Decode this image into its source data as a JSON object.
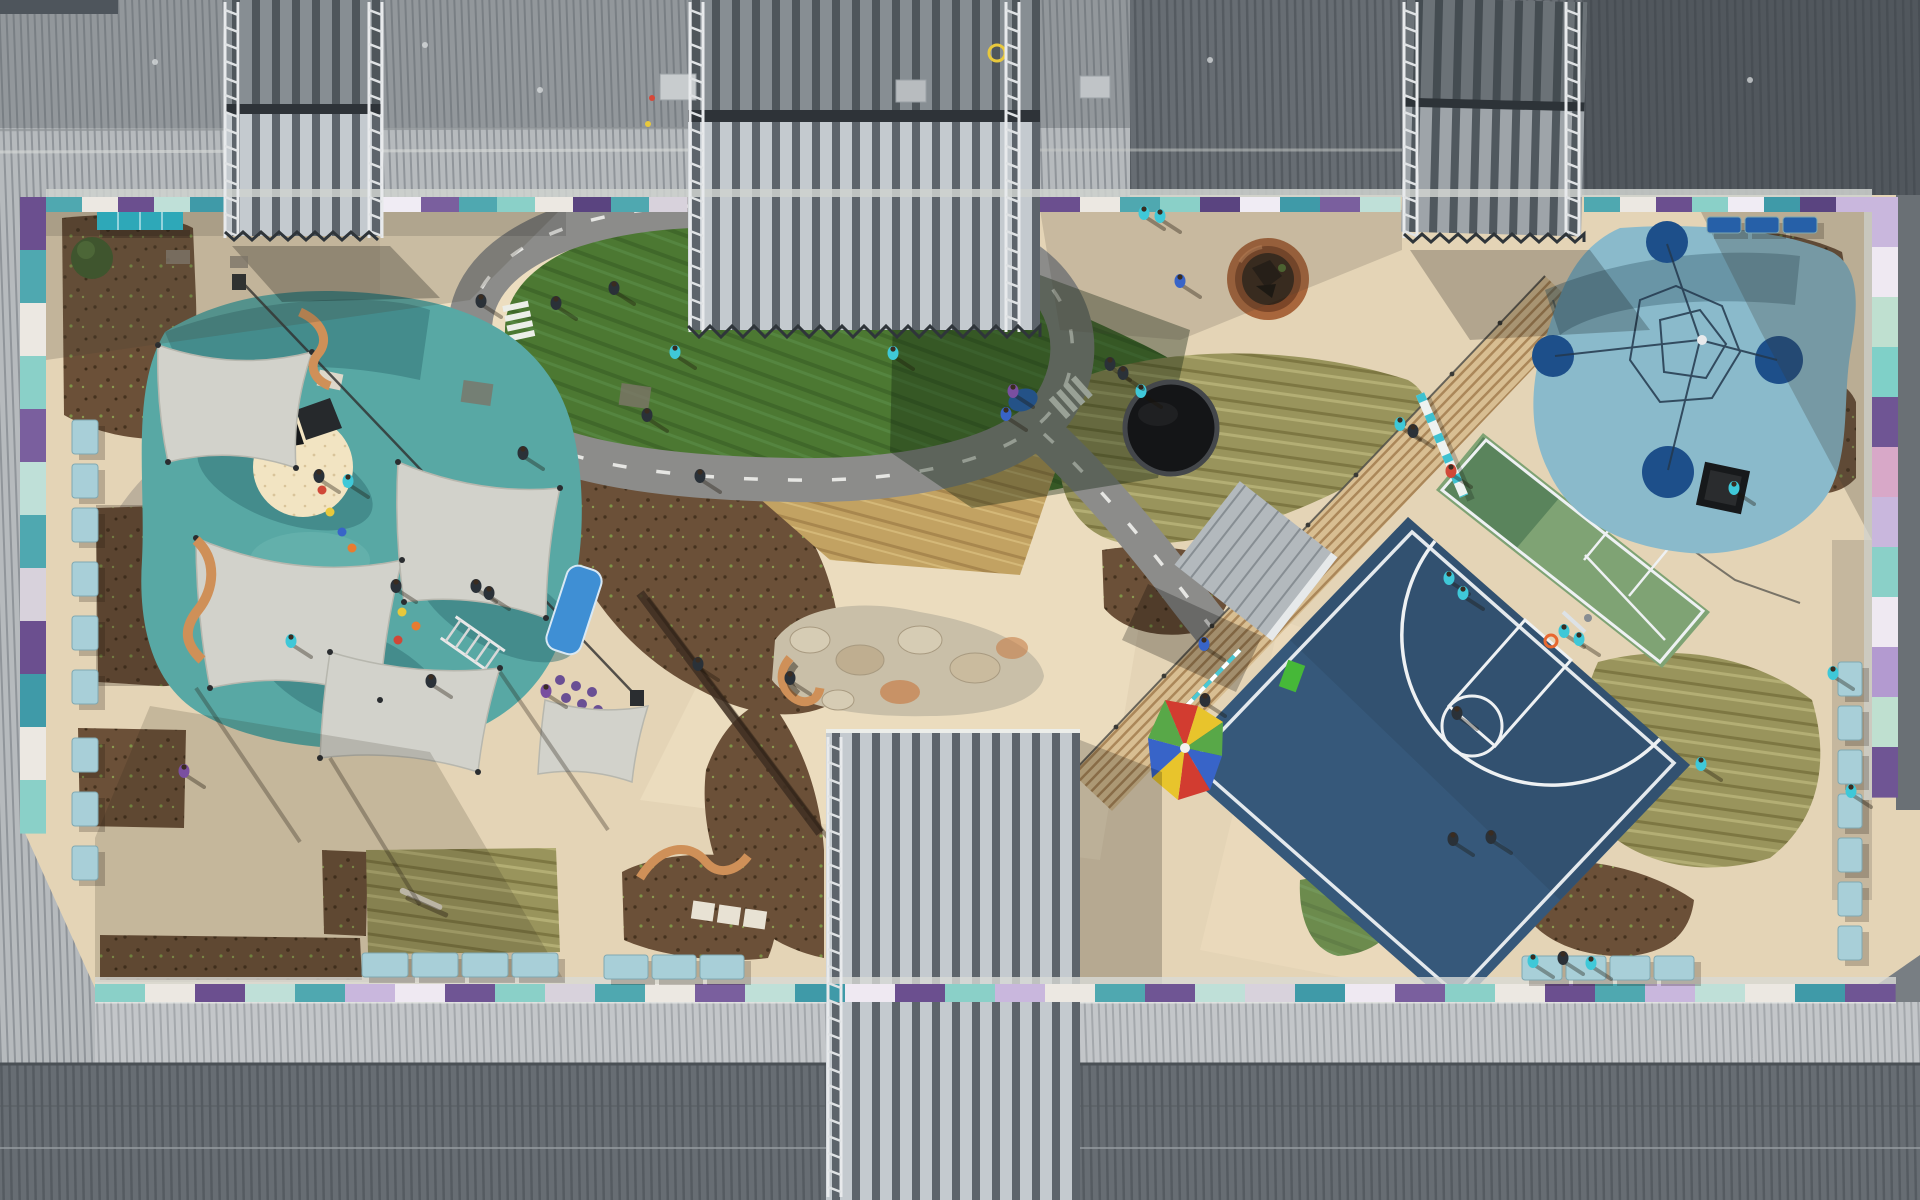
{
  "scene": {
    "type": "aerial-drone-photograph",
    "description": "Top-down aerial view of a school courtyard playground surrounded by gray corrugated metal roofs",
    "areas": [
      "shade-sail playground",
      "bike track with grass oval",
      "trampoline",
      "fire pit",
      "basketball court",
      "green multi-court",
      "climbing-net playground",
      "sand pit",
      "garden beds",
      "bench rows",
      "rainbow parachute",
      "boardwalk"
    ]
  },
  "palette": {
    "tan": "#e4d4b6",
    "tanBright": "#f4e6c8",
    "concreteShade": "#b2a390",
    "teal": "#58a8a4",
    "tealDark": "#2f6f74",
    "blueCourt": "#36587a",
    "greenCourt": "#7fa374",
    "greenCourtDark": "#56815a",
    "grass": "#4c7832",
    "grassDark": "#2f4f1e",
    "grassDry": "#99945c",
    "bluePlay": "#8abacb",
    "navyCircle": "#1d4f8a",
    "sand": "#f2e4c2",
    "mulch": "#6b5038",
    "sail": "#d2d2cb",
    "track": "#8c8c8a",
    "stone": "#c9bfa8",
    "wood": "#d8be92",
    "benchBlue": "#a8cfd8",
    "benchTeal": "#2ea8b8",
    "navyBench": "#2660a8",
    "orangeBench": "#cf9058",
    "trampoline": "#141517",
    "firepitRing": "#a8663c",
    "firepitInner": "#35261a",
    "roofLight": "#b6babd",
    "roofDark": "#62686e",
    "kidCyan": "#3fc8d8",
    "kidDark": "#2a3138",
    "kidPurple": "#7a4fa0",
    "kidRed": "#d04838",
    "kidBlue": "#3864c8",
    "parachute": [
      "#d23c30",
      "#e8c42c",
      "#58a848",
      "#3864c8"
    ]
  },
  "strips": [
    {
      "name": "wall-panels-top-1",
      "dir": "h",
      "x": 46,
      "y": 197,
      "block": 36,
      "h": 15,
      "colors": [
        "#4fa8b0",
        "#ece8e2",
        "#6b4f8f",
        "#bfe0d8",
        "#3f9aa8"
      ]
    },
    {
      "name": "wall-panels-top-2",
      "dir": "h",
      "x": 383,
      "y": 197,
      "block": 38,
      "h": 15,
      "colors": [
        "#f0ecf4",
        "#7a5f9e",
        "#4fa8b0",
        "#8ad0c8",
        "#ece8e2",
        "#5a4480",
        "#4fa8b0",
        "#d8d2dc"
      ]
    },
    {
      "name": "wall-panels-top-3",
      "dir": "h",
      "x": 1040,
      "y": 197,
      "block": 40,
      "h": 15,
      "colors": [
        "#6b4f8f",
        "#ece8e2",
        "#4fa8b0",
        "#8ad0c8",
        "#5a4480",
        "#f0ecf4",
        "#3f9aa8",
        "#7a5f9e",
        "#bfe0d8"
      ]
    },
    {
      "name": "wall-panels-top-4",
      "dir": "h",
      "x": 1584,
      "y": 197,
      "block": 36,
      "h": 15,
      "colors": [
        "#4fa8b0",
        "#ece8e2",
        "#6b4f8f",
        "#8ad0c8",
        "#f0ecf4",
        "#3f9aa8",
        "#5a4480",
        "#c9b7dd"
      ]
    },
    {
      "name": "wall-panels-left",
      "dir": "v",
      "x": 20,
      "y": 197,
      "block": 53,
      "w": 26,
      "colors": [
        "#6b4f8f",
        "#4fa8b0",
        "#ece8e2",
        "#8ad0c8",
        "#7a5f9e",
        "#bfe0d8",
        "#4fa8b0",
        "#d8d2dc",
        "#6b4f8f",
        "#3f9aa8",
        "#ece8e2",
        "#8ad0c8"
      ]
    },
    {
      "name": "wall-panels-right",
      "dir": "v",
      "x": 1872,
      "y": 197,
      "block": 50,
      "w": 26,
      "colors": [
        "#c9b7dd",
        "#efe9f2",
        "#bfe0d0",
        "#7fd0c8",
        "#6f5594",
        "#d8a8c8",
        "#c9b7dd",
        "#8ad0c8",
        "#efe9f2",
        "#b39ad0",
        "#bfe0d0",
        "#6f5594"
      ]
    },
    {
      "name": "wall-panels-bottom",
      "dir": "h",
      "x": 95,
      "y": 984,
      "block": 50,
      "h": 18,
      "colors": [
        "#8ad0c8",
        "#ece8e2",
        "#6b4f8f",
        "#bfe0d8",
        "#4fa8b0",
        "#c9b7dd",
        "#efe9f2",
        "#6f5594",
        "#8ad0c8",
        "#d8d2dc",
        "#4fa8b0",
        "#ece8e2",
        "#7a5f9e",
        "#bfe0d8",
        "#3f9aa8",
        "#efe9f2",
        "#6b4f8f",
        "#8ad0c8",
        "#c9b7dd",
        "#ece8e2",
        "#4fa8b0",
        "#6f5594",
        "#bfe0d8",
        "#d8d2dc",
        "#3f9aa8",
        "#efe9f2",
        "#7a5f9e",
        "#8ad0c8",
        "#ece8e2",
        "#6b4f8f",
        "#4fa8b0",
        "#c9b7dd",
        "#bfe0d8",
        "#ece8e2",
        "#3f9aa8",
        "#6f5594"
      ]
    }
  ],
  "benches": [
    {
      "name": "bench-column-left",
      "x": 72,
      "w": 26,
      "h": 34,
      "ys": [
        420,
        464,
        508,
        562,
        616,
        670,
        738,
        792,
        846
      ],
      "fill": "#a8cfd8"
    },
    {
      "name": "bench-row-bottom-left",
      "y": 953,
      "w": 46,
      "h": 24,
      "xs": [
        362,
        412,
        462,
        512
      ],
      "fill": "#a8cfd8"
    },
    {
      "name": "bench-row-bottom-mid",
      "y": 955,
      "w": 44,
      "h": 24,
      "xs": [
        604,
        652,
        700
      ],
      "fill": "#a8cfd8"
    },
    {
      "name": "bench-row-bottom-right",
      "y": 956,
      "w": 40,
      "h": 24,
      "xs": [
        1522,
        1566,
        1610,
        1654
      ],
      "fill": "#a8cfd8"
    },
    {
      "name": "bench-column-right",
      "x": 1838,
      "w": 24,
      "h": 34,
      "ys": [
        662,
        706,
        750,
        794,
        838,
        882,
        926
      ],
      "fill": "#a8cfd8"
    },
    {
      "name": "bench-row-top-right",
      "y": 217,
      "w": 34,
      "h": 16,
      "xs": [
        1707,
        1745,
        1783
      ],
      "fill": "#2660a8"
    }
  ],
  "ladders": [
    {
      "x": 225,
      "y": 2,
      "h": 236
    },
    {
      "x": 369,
      "y": 2,
      "h": 236
    },
    {
      "x": 690,
      "y": 2,
      "h": 330
    },
    {
      "x": 1006,
      "y": 2,
      "h": 330
    },
    {
      "x": 1404,
      "y": 2,
      "h": 236
    },
    {
      "x": 1566,
      "y": 2,
      "h": 236
    },
    {
      "x": 828,
      "y": 737,
      "h": 460
    }
  ],
  "sawteeth": [
    {
      "x1": 688,
      "x2": 1040,
      "y": 326,
      "amp": 11,
      "step": 22
    },
    {
      "x1": 225,
      "x2": 383,
      "y": 232,
      "amp": 8,
      "step": 18
    },
    {
      "x1": 1404,
      "x2": 1584,
      "y": 234,
      "amp": 8,
      "step": 18
    }
  ],
  "people": [
    [
      675,
      352,
      "C"
    ],
    [
      893,
      353,
      "C"
    ],
    [
      647,
      415,
      "D"
    ],
    [
      556,
      303,
      "D"
    ],
    [
      614,
      288,
      "D"
    ],
    [
      481,
      301,
      "D"
    ],
    [
      523,
      453,
      "D"
    ],
    [
      700,
      476,
      "D"
    ],
    [
      1006,
      414,
      "B"
    ],
    [
      1110,
      364,
      "D"
    ],
    [
      1180,
      281,
      "B"
    ],
    [
      1144,
      213,
      "C"
    ],
    [
      1160,
      216,
      "C"
    ],
    [
      1141,
      391,
      "C"
    ],
    [
      1123,
      373,
      "D"
    ],
    [
      1013,
      391,
      "P"
    ],
    [
      1204,
      644,
      "B"
    ],
    [
      1400,
      424,
      "C"
    ],
    [
      1413,
      431,
      "D"
    ],
    [
      1451,
      471,
      "R"
    ],
    [
      1449,
      578,
      "C"
    ],
    [
      1463,
      593,
      "C"
    ],
    [
      1457,
      713,
      "D"
    ],
    [
      1453,
      839,
      "D"
    ],
    [
      1491,
      837,
      "D"
    ],
    [
      1564,
      631,
      "C"
    ],
    [
      1579,
      639,
      "C"
    ],
    [
      1701,
      764,
      "C"
    ],
    [
      1833,
      673,
      "C"
    ],
    [
      1851,
      791,
      "C"
    ],
    [
      1734,
      488,
      "C"
    ],
    [
      348,
      481,
      "C"
    ],
    [
      396,
      586,
      "D"
    ],
    [
      431,
      681,
      "D"
    ],
    [
      476,
      586,
      "D"
    ],
    [
      489,
      593,
      "D"
    ],
    [
      319,
      476,
      "D"
    ],
    [
      184,
      771,
      "P"
    ],
    [
      546,
      691,
      "P"
    ],
    [
      291,
      641,
      "C"
    ],
    [
      1533,
      961,
      "C"
    ],
    [
      1563,
      958,
      "D"
    ],
    [
      1591,
      963,
      "C"
    ],
    [
      698,
      664,
      "D"
    ],
    [
      790,
      678,
      "D"
    ],
    [
      1205,
      700,
      "D"
    ]
  ]
}
